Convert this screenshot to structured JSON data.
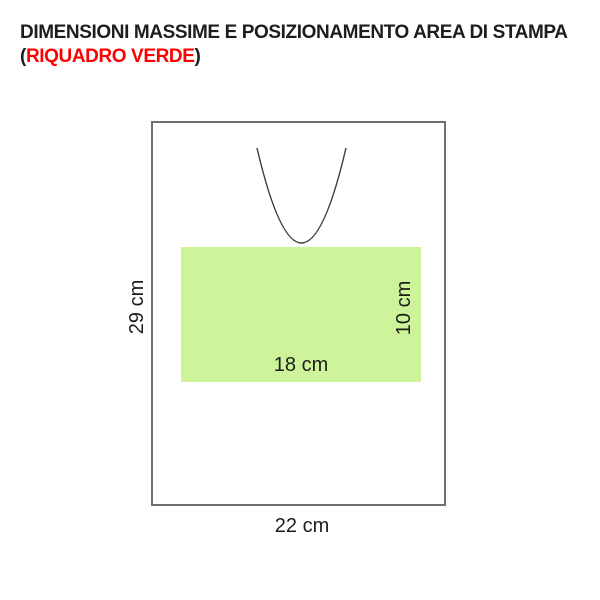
{
  "title": {
    "line1": "DIMENSIONI MASSIME E POSIZIONAMENTO AREA DI STAMPA",
    "line2_open": "(",
    "line2_highlight": "RIQUADRO VERDE",
    "line2_close": ")"
  },
  "diagram": {
    "labels": {
      "bag_height": "29 cm",
      "bag_width": "22 cm",
      "print_width": "18 cm",
      "print_height": "10 cm"
    }
  },
  "colors": {
    "title_black": "#1d1d1b",
    "highlight_red": "#ff0000",
    "print_area_green": "#cdf49b",
    "bag_border": "#6f6f6f",
    "handle_line": "#3c3c3b",
    "label_text": "#1d1d1b"
  }
}
